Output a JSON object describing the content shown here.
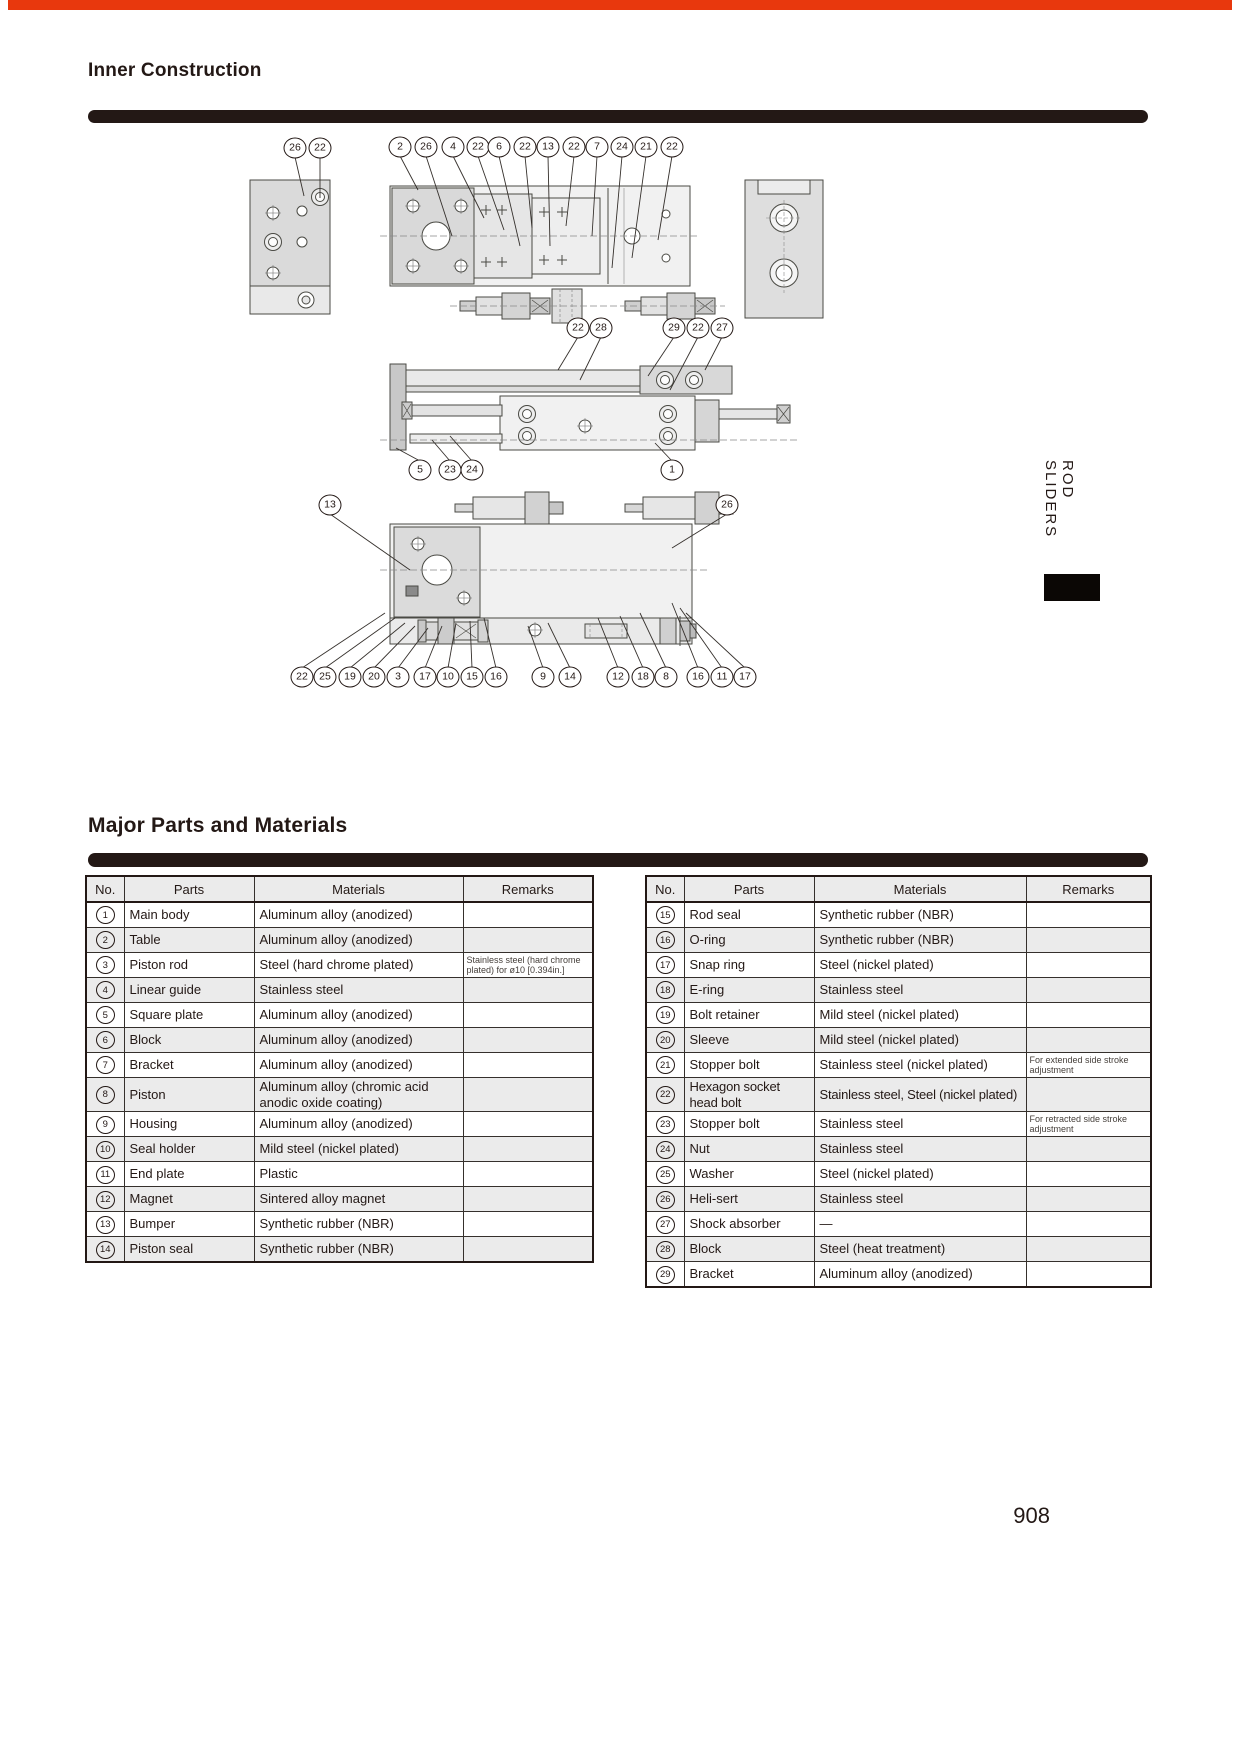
{
  "page": {
    "top_bar_color": "#e8380d",
    "page_number": "908",
    "side_tab_label": "ROD SLIDERS"
  },
  "sections": {
    "inner_construction_title": "Inner Construction",
    "parts_title": "Major Parts and Materials"
  },
  "diagram": {
    "callouts": [
      {
        "n": "26",
        "x": 215,
        "y": 30,
        "tx": 224,
        "ty": 78
      },
      {
        "n": "22",
        "x": 240,
        "y": 30,
        "tx": 240,
        "ty": 80
      },
      {
        "n": "2",
        "x": 320,
        "y": 29,
        "tx": 338,
        "ty": 72
      },
      {
        "n": "26",
        "x": 346,
        "y": 29,
        "tx": 372,
        "ty": 118
      },
      {
        "n": "4",
        "x": 373,
        "y": 29,
        "tx": 404,
        "ty": 100
      },
      {
        "n": "22",
        "x": 398,
        "y": 29,
        "tx": 424,
        "ty": 112
      },
      {
        "n": "6",
        "x": 419,
        "y": 29,
        "tx": 440,
        "ty": 128
      },
      {
        "n": "22",
        "x": 445,
        "y": 29,
        "tx": 452,
        "ty": 110
      },
      {
        "n": "13",
        "x": 468,
        "y": 29,
        "tx": 470,
        "ty": 128
      },
      {
        "n": "22",
        "x": 494,
        "y": 29,
        "tx": 486,
        "ty": 108
      },
      {
        "n": "7",
        "x": 517,
        "y": 29,
        "tx": 512,
        "ty": 118
      },
      {
        "n": "24",
        "x": 542,
        "y": 29,
        "tx": 532,
        "ty": 150
      },
      {
        "n": "21",
        "x": 566,
        "y": 29,
        "tx": 552,
        "ty": 140
      },
      {
        "n": "22",
        "x": 592,
        "y": 29,
        "tx": 578,
        "ty": 122
      },
      {
        "n": "22",
        "x": 498,
        "y": 210,
        "tx": 478,
        "ty": 252
      },
      {
        "n": "28",
        "x": 521,
        "y": 210,
        "tx": 500,
        "ty": 262
      },
      {
        "n": "29",
        "x": 594,
        "y": 210,
        "tx": 568,
        "ty": 258
      },
      {
        "n": "22",
        "x": 618,
        "y": 210,
        "tx": 590,
        "ty": 272
      },
      {
        "n": "27",
        "x": 642,
        "y": 210,
        "tx": 625,
        "ty": 252
      },
      {
        "n": "5",
        "x": 340,
        "y": 352,
        "tx": 316,
        "ty": 330
      },
      {
        "n": "23",
        "x": 370,
        "y": 352,
        "tx": 352,
        "ty": 322
      },
      {
        "n": "24",
        "x": 392,
        "y": 352,
        "tx": 370,
        "ty": 318
      },
      {
        "n": "1",
        "x": 592,
        "y": 352,
        "tx": 575,
        "ty": 325
      },
      {
        "n": "13",
        "x": 250,
        "y": 387,
        "tx": 330,
        "ty": 452
      },
      {
        "n": "26",
        "x": 647,
        "y": 387,
        "tx": 592,
        "ty": 430
      },
      {
        "n": "22",
        "x": 222,
        "y": 559,
        "tx": 305,
        "ty": 495
      },
      {
        "n": "25",
        "x": 245,
        "y": 559,
        "tx": 315,
        "ty": 500
      },
      {
        "n": "19",
        "x": 270,
        "y": 559,
        "tx": 325,
        "ty": 505
      },
      {
        "n": "20",
        "x": 294,
        "y": 559,
        "tx": 335,
        "ty": 508
      },
      {
        "n": "3",
        "x": 318,
        "y": 559,
        "tx": 348,
        "ty": 510
      },
      {
        "n": "17",
        "x": 345,
        "y": 559,
        "tx": 362,
        "ty": 508
      },
      {
        "n": "10",
        "x": 368,
        "y": 559,
        "tx": 376,
        "ty": 505
      },
      {
        "n": "15",
        "x": 392,
        "y": 559,
        "tx": 390,
        "ty": 503
      },
      {
        "n": "16",
        "x": 416,
        "y": 559,
        "tx": 404,
        "ty": 500
      },
      {
        "n": "9",
        "x": 463,
        "y": 559,
        "tx": 448,
        "ty": 508
      },
      {
        "n": "14",
        "x": 490,
        "y": 559,
        "tx": 468,
        "ty": 505
      },
      {
        "n": "12",
        "x": 538,
        "y": 559,
        "tx": 518,
        "ty": 500
      },
      {
        "n": "18",
        "x": 563,
        "y": 559,
        "tx": 540,
        "ty": 498
      },
      {
        "n": "8",
        "x": 586,
        "y": 559,
        "tx": 560,
        "ty": 495
      },
      {
        "n": "16",
        "x": 618,
        "y": 559,
        "tx": 592,
        "ty": 485
      },
      {
        "n": "11",
        "x": 642,
        "y": 559,
        "tx": 600,
        "ty": 490
      },
      {
        "n": "17",
        "x": 665,
        "y": 559,
        "tx": 606,
        "ty": 495
      }
    ]
  },
  "tables": {
    "headers": [
      "No.",
      "Parts",
      "Materials",
      "Remarks"
    ],
    "left_rows": [
      {
        "no": "1",
        "parts": "Main body",
        "materials": "Aluminum alloy (anodized)",
        "remarks": ""
      },
      {
        "no": "2",
        "parts": "Table",
        "materials": "Aluminum alloy (anodized)",
        "remarks": ""
      },
      {
        "no": "3",
        "parts": "Piston rod",
        "materials": "Steel (hard chrome plated)",
        "remarks": "Stainless steel (hard chrome plated) for ø10 [0.394in.]"
      },
      {
        "no": "4",
        "parts": "Linear guide",
        "materials": "Stainless steel",
        "remarks": ""
      },
      {
        "no": "5",
        "parts": "Square plate",
        "materials": "Aluminum alloy (anodized)",
        "remarks": ""
      },
      {
        "no": "6",
        "parts": "Block",
        "materials": "Aluminum alloy (anodized)",
        "remarks": ""
      },
      {
        "no": "7",
        "parts": "Bracket",
        "materials": "Aluminum alloy (anodized)",
        "remarks": ""
      },
      {
        "no": "8",
        "parts": "Piston",
        "materials": "Aluminum alloy (chromic acid anodic oxide coating)",
        "remarks": ""
      },
      {
        "no": "9",
        "parts": "Housing",
        "materials": "Aluminum alloy (anodized)",
        "remarks": ""
      },
      {
        "no": "10",
        "parts": "Seal holder",
        "materials": "Mild steel (nickel plated)",
        "remarks": ""
      },
      {
        "no": "11",
        "parts": "End plate",
        "materials": "Plastic",
        "remarks": ""
      },
      {
        "no": "12",
        "parts": "Magnet",
        "materials": "Sintered alloy magnet",
        "remarks": ""
      },
      {
        "no": "13",
        "parts": "Bumper",
        "materials": "Synthetic rubber (NBR)",
        "remarks": ""
      },
      {
        "no": "14",
        "parts": "Piston seal",
        "materials": "Synthetic rubber (NBR)",
        "remarks": ""
      }
    ],
    "right_rows": [
      {
        "no": "15",
        "parts": "Rod seal",
        "materials": "Synthetic rubber (NBR)",
        "remarks": ""
      },
      {
        "no": "16",
        "parts": "O-ring",
        "materials": "Synthetic rubber (NBR)",
        "remarks": ""
      },
      {
        "no": "17",
        "parts": "Snap ring",
        "materials": "Steel (nickel plated)",
        "remarks": ""
      },
      {
        "no": "18",
        "parts": "E-ring",
        "materials": "Stainless steel",
        "remarks": ""
      },
      {
        "no": "19",
        "parts": "Bolt retainer",
        "materials": "Mild steel (nickel plated)",
        "remarks": ""
      },
      {
        "no": "20",
        "parts": "Sleeve",
        "materials": "Mild steel (nickel plated)",
        "remarks": ""
      },
      {
        "no": "21",
        "parts": "Stopper bolt",
        "materials": "Stainless steel (nickel plated)",
        "remarks": "For extended side stroke adjustment"
      },
      {
        "no": "22",
        "parts": "Hexagon socket head bolt",
        "materials": "Stainless steel, Steel (nickel plated)",
        "remarks": ""
      },
      {
        "no": "23",
        "parts": "Stopper bolt",
        "materials": "Stainless steel",
        "remarks": "For retracted side stroke adjustment"
      },
      {
        "no": "24",
        "parts": "Nut",
        "materials": "Stainless steel",
        "remarks": ""
      },
      {
        "no": "25",
        "parts": "Washer",
        "materials": "Steel (nickel plated)",
        "remarks": ""
      },
      {
        "no": "26",
        "parts": "Heli-sert",
        "materials": "Stainless steel",
        "remarks": ""
      },
      {
        "no": "27",
        "parts": "Shock absorber",
        "materials": "—",
        "remarks": ""
      },
      {
        "no": "28",
        "parts": "Block",
        "materials": "Steel (heat treatment)",
        "remarks": ""
      },
      {
        "no": "29",
        "parts": "Bracket",
        "materials": "Aluminum alloy (anodized)",
        "remarks": ""
      }
    ]
  }
}
